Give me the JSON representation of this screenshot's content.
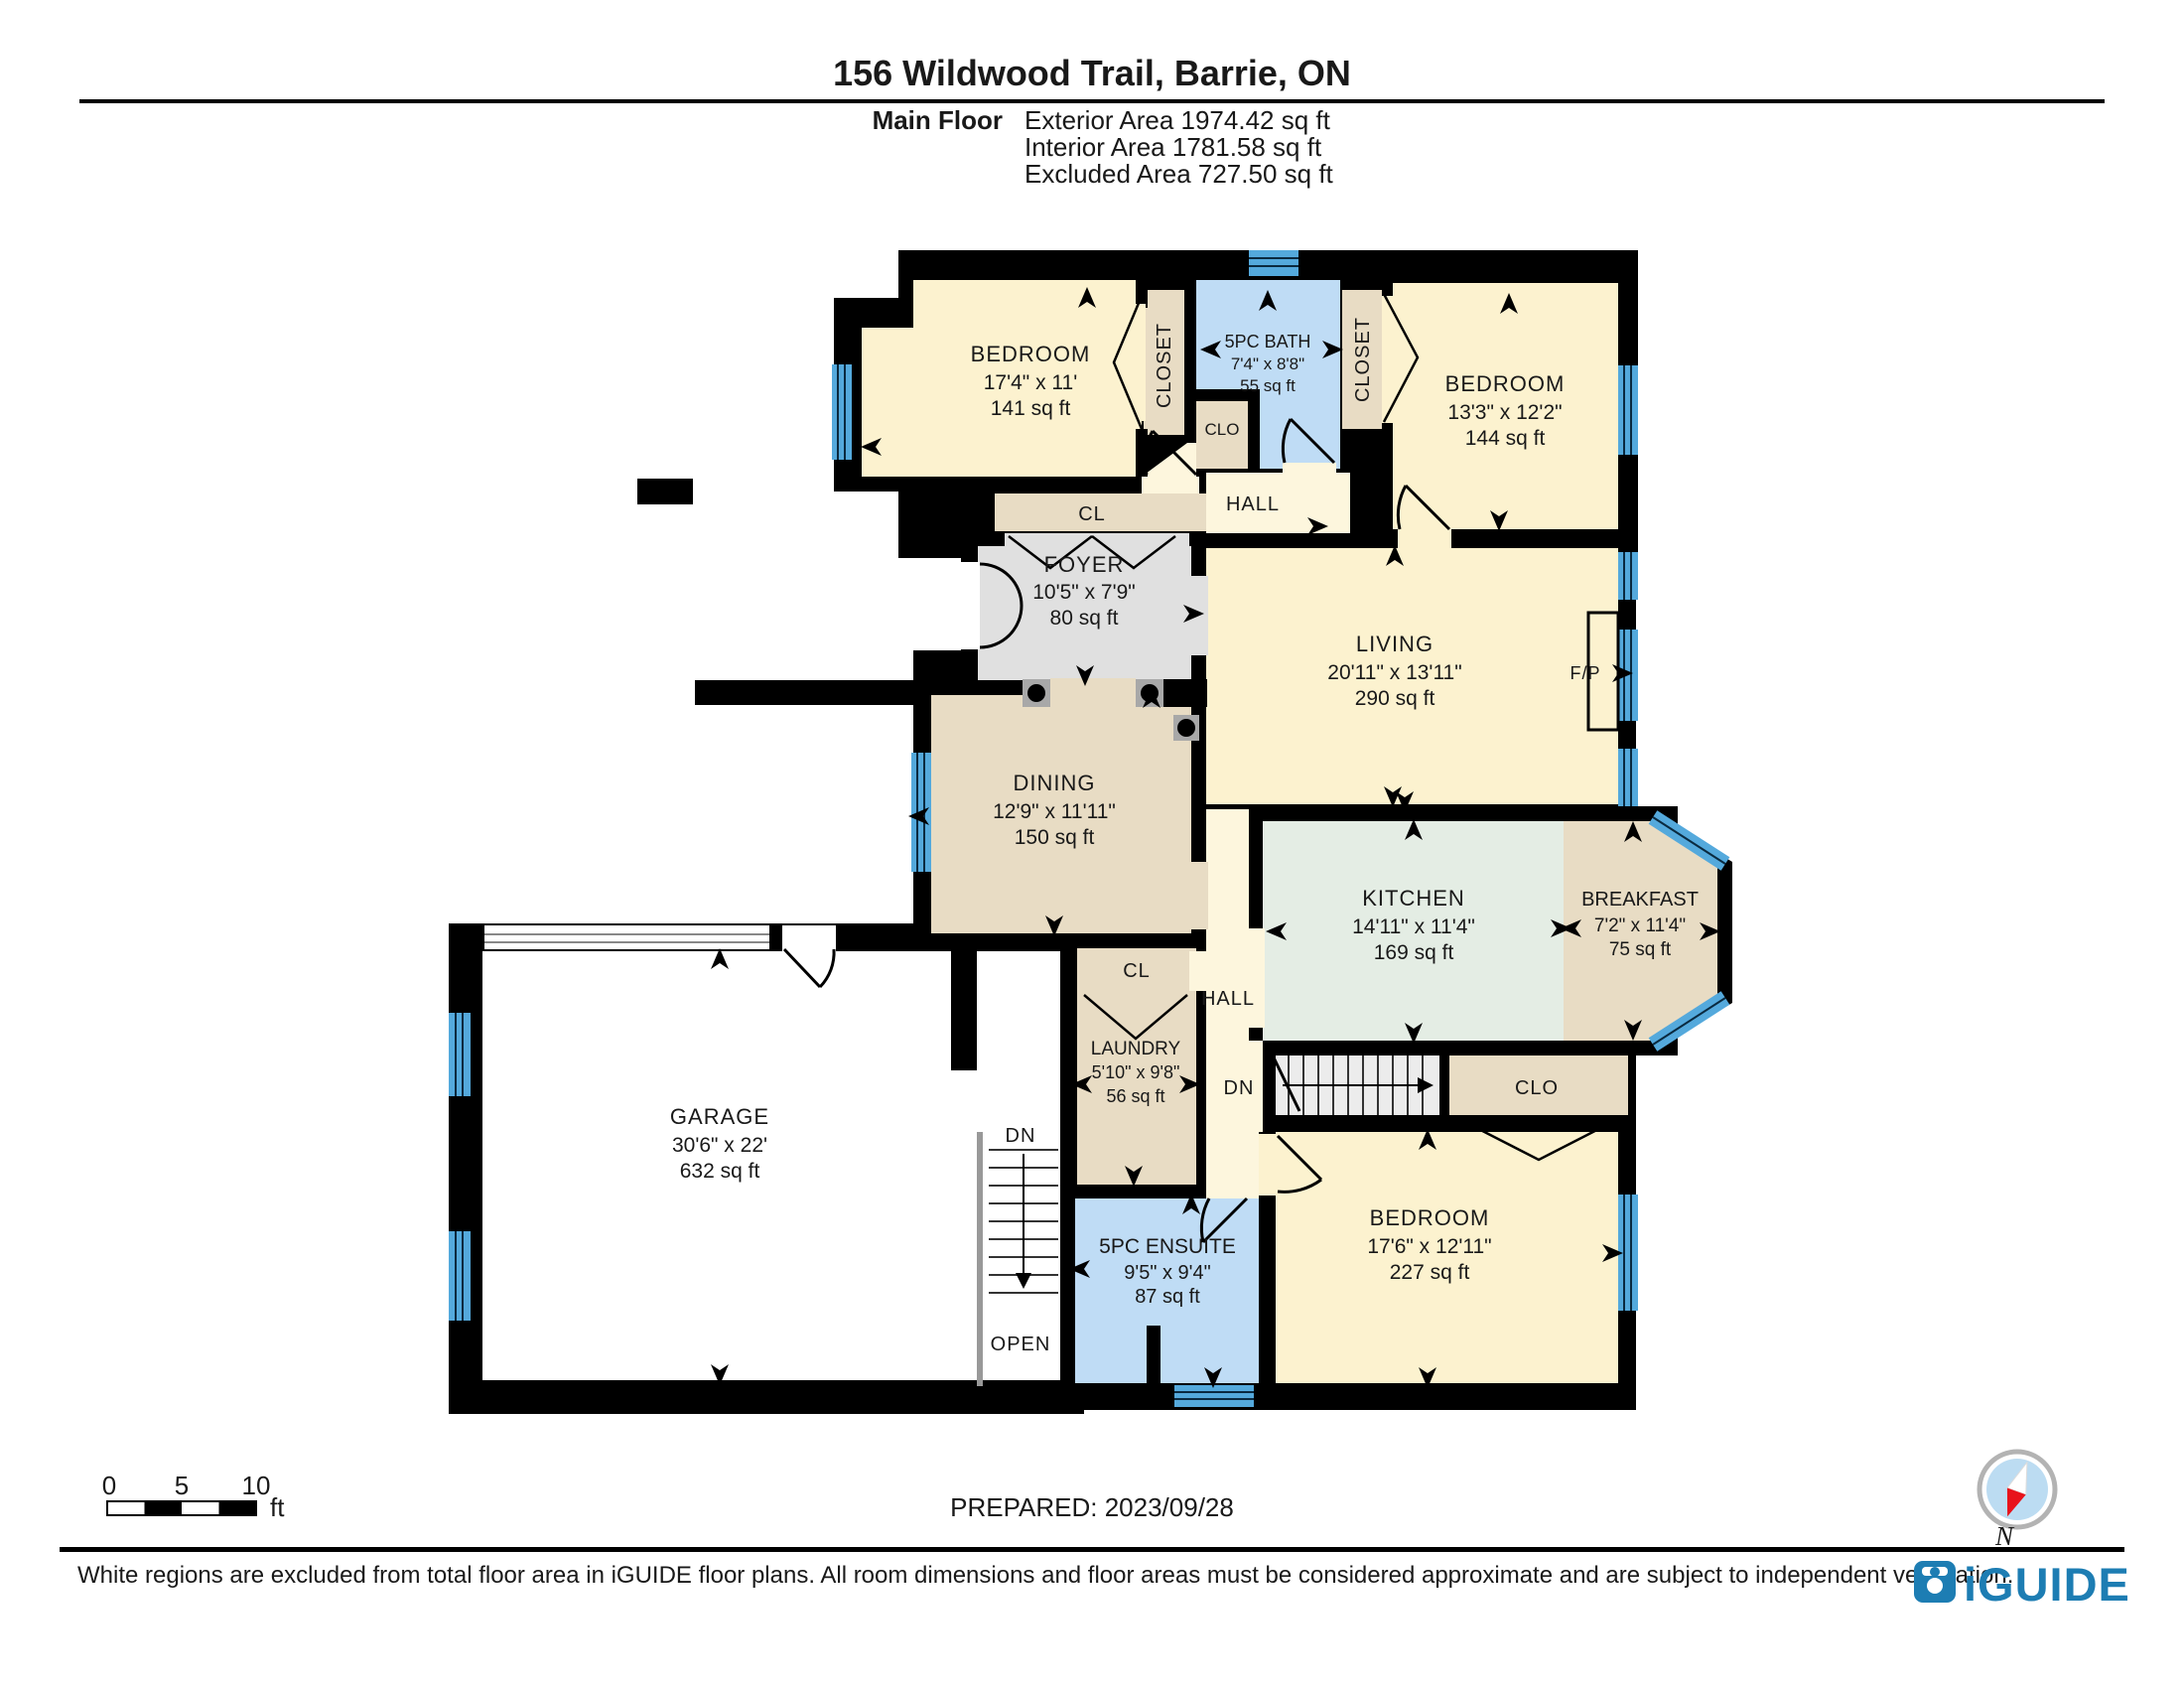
{
  "header": {
    "title": "156 Wildwood Trail, Barrie, ON",
    "floor_label": "Main Floor",
    "stats": [
      "Exterior Area 1974.42 sq ft",
      "Interior Area 1781.58 sq ft",
      "Excluded Area 727.50 sq ft"
    ]
  },
  "rooms": [
    {
      "id": "bedroom-1",
      "name": "BEDROOM",
      "dims": "17'4\" x 11'",
      "area": "141 sq ft"
    },
    {
      "id": "bath",
      "name": "5PC BATH",
      "dims": "7'4\" x 8'8\"",
      "area": "55 sq ft"
    },
    {
      "id": "bedroom-2",
      "name": "BEDROOM",
      "dims": "13'3\" x 12'2\"",
      "area": "144 sq ft"
    },
    {
      "id": "foyer",
      "name": "FOYER",
      "dims": "10'5\" x 7'9\"",
      "area": "80 sq ft"
    },
    {
      "id": "living",
      "name": "LIVING",
      "dims": "20'11\" x 13'11\"",
      "area": "290 sq ft"
    },
    {
      "id": "dining",
      "name": "DINING",
      "dims": "12'9\" x 11'11\"",
      "area": "150 sq ft"
    },
    {
      "id": "kitchen",
      "name": "KITCHEN",
      "dims": "14'11\" x 11'4\"",
      "area": "169 sq ft"
    },
    {
      "id": "breakfast",
      "name": "BREAKFAST",
      "dims": "7'2\" x 11'4\"",
      "area": "75 sq ft"
    },
    {
      "id": "garage",
      "name": "GARAGE",
      "dims": "30'6\" x 22'",
      "area": "632 sq ft"
    },
    {
      "id": "laundry",
      "name": "LAUNDRY",
      "dims": "5'10\" x 9'8\"",
      "area": "56 sq ft"
    },
    {
      "id": "ensuite",
      "name": "5PC ENSUITE",
      "dims": "9'5\" x 9'4\"",
      "area": "87 sq ft"
    },
    {
      "id": "bedroom-3",
      "name": "BEDROOM",
      "dims": "17'6\" x 12'11\"",
      "area": "227 sq ft"
    }
  ],
  "labels": {
    "closet_left": "CLOSET",
    "closet_right": "CLOSET",
    "clo_bath": "CLO",
    "cl_upper": "CL",
    "hall_upper": "HALL",
    "fireplace": "F/P",
    "cl_lower": "CL",
    "hall_lower": "HALL",
    "dn_right": "DN",
    "clo_lower": "CLO",
    "dn_left": "DN",
    "open": "OPEN"
  },
  "scale_bar": {
    "start": "0",
    "mid": "5",
    "end": "10",
    "unit": "ft"
  },
  "compass": {
    "north_label": "N"
  },
  "footer": {
    "prepared": "PREPARED: 2023/09/28",
    "disclaimer": "White regions are excluded from total floor area in iGUIDE floor plans. All room dimensions and floor areas must be considered approximate and are subject to independent verification.",
    "logo_text": "iGUIDE"
  },
  "colors": {
    "wall": "#000000",
    "window": "#54a9dc",
    "room_cream": "#fcf2cf",
    "room_tan": "#e8dcc4",
    "room_blue": "#bfdcf5",
    "room_gray": "#e0e0e0",
    "room_mint": "#e4ede4",
    "hall_pale": "#fdf6dd",
    "logo_blue": "#1d7db3"
  }
}
